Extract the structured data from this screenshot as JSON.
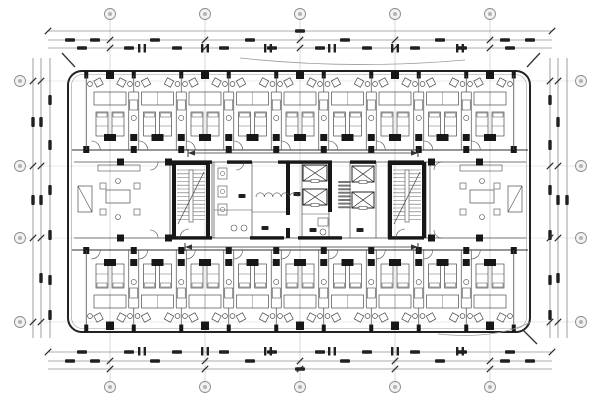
{
  "drawing": {
    "kind": "architectural-floor-plan-scan",
    "description": "typical hotel guest-room floor plan, double-loaded corridor, central core",
    "legible_text": "",
    "colors": {
      "bg": "#ffffff",
      "line": "#4b4b4b",
      "dark": "#171717",
      "light": "#9b9b9b",
      "dim": "#5e5e5e",
      "blob": "#202020",
      "bubble_stroke": "#8a8a8a",
      "bubble_fill": "#f2f2f2"
    }
  },
  "canvas": {
    "w": 600,
    "h": 400
  },
  "grid": {
    "top_bubbles": {
      "y": 14,
      "r": 5.5,
      "xs": [
        110,
        205,
        300,
        395,
        490
      ],
      "labels": [
        "",
        "",
        "",
        "",
        ""
      ]
    },
    "bottom_bubbles": {
      "y": 387,
      "r": 5.5,
      "xs": [
        110,
        205,
        300,
        395,
        490
      ],
      "labels": [
        "",
        "",
        "",
        "",
        ""
      ]
    },
    "left_bubbles": {
      "x": 20,
      "r": 5.5,
      "ys": [
        81,
        166,
        238,
        322
      ],
      "labels": [
        "",
        "",
        "",
        ""
      ]
    },
    "right_bubbles": {
      "x": 581,
      "r": 5.5,
      "ys": [
        81,
        166,
        238,
        322
      ],
      "labels": [
        "",
        "",
        "",
        ""
      ]
    }
  },
  "dims": {
    "top": {
      "ys": [
        31,
        40,
        48
      ],
      "x1": 48,
      "x2": 552,
      "blob_rows": [
        {
          "y": 31,
          "xs": [
            300
          ]
        },
        {
          "y": 40,
          "xs": [
            70,
            95,
            155,
            250,
            345,
            440,
            505,
            530
          ]
        },
        {
          "y": 48,
          "xs": [
            82,
            129,
            177,
            224,
            272,
            320,
            367,
            415,
            462,
            510
          ]
        }
      ],
      "hpairs": [
        142,
        205,
        268,
        332,
        395,
        460
      ],
      "hpair_y": 44
    },
    "bottom": {
      "ys": [
        352,
        361,
        369
      ],
      "x1": 48,
      "x2": 552,
      "blob_rows": [
        {
          "y": 352,
          "xs": [
            82,
            129,
            177,
            224,
            272,
            320,
            367,
            415,
            462,
            510
          ]
        },
        {
          "y": 361,
          "xs": [
            70,
            95,
            155,
            250,
            345,
            440,
            505,
            530
          ]
        },
        {
          "y": 369,
          "xs": [
            300
          ]
        }
      ],
      "hpairs": [
        142,
        205,
        268,
        332,
        395,
        460
      ],
      "hpair_y": 347
    },
    "left": {
      "xs": [
        33,
        41,
        50
      ],
      "y1": 58,
      "y2": 338,
      "blob_cols": [
        {
          "x": 33,
          "ys": [
            122,
            200
          ]
        },
        {
          "x": 41,
          "ys": [
            122,
            200,
            278
          ]
        },
        {
          "x": 50,
          "ys": [
            100,
            145,
            190,
            235,
            280,
            315
          ]
        }
      ]
    },
    "right": {
      "xs": [
        550,
        558,
        567
      ],
      "y1": 58,
      "y2": 338,
      "blob_cols": [
        {
          "x": 567,
          "ys": [
            200
          ]
        },
        {
          "x": 558,
          "ys": [
            122,
            200,
            278
          ]
        },
        {
          "x": 550,
          "ys": [
            100,
            145,
            190,
            235,
            280,
            315
          ]
        }
      ]
    }
  },
  "building": {
    "x": 68,
    "y": 71,
    "w": 462,
    "h": 261,
    "rx": 14,
    "inner_inset": 3.5
  },
  "bands": {
    "top": {
      "y0": 75,
      "y1": 150,
      "half": 23.75,
      "centers": [
        110,
        157.5,
        205,
        252.5,
        300,
        347.5,
        395,
        442.5,
        490
      ]
    },
    "bottom": {
      "y0": 250,
      "y1": 325,
      "half": 23.75,
      "centers": [
        110,
        157.5,
        205,
        252.5,
        300,
        347.5,
        395,
        442.5,
        490
      ]
    }
  },
  "corridors": {
    "top_wall_y": 150,
    "bottom_wall_y": 250,
    "x1": 72,
    "x2": 528,
    "arrows": [
      {
        "x1": 188,
        "x2": 418,
        "y": 153
      },
      {
        "x1": 185,
        "x2": 418,
        "y": 247
      }
    ]
  },
  "core": {
    "y0": 162,
    "y1": 238,
    "thin_v": [
      170,
      212,
      214,
      252,
      302,
      329,
      350,
      376,
      388,
      426,
      430
    ],
    "h_thin": [
      [
        214,
        252,
        210
      ],
      [
        252,
        286,
        212
      ],
      [
        302,
        329,
        214
      ]
    ],
    "thick_h_top": [
      [
        172,
        212
      ],
      [
        227,
        252
      ],
      [
        278,
        332
      ],
      [
        350,
        376
      ],
      [
        388,
        424
      ]
    ],
    "thick_h_bot": [
      [
        172,
        212
      ],
      [
        250,
        284
      ],
      [
        298,
        342
      ],
      [
        388,
        424
      ]
    ],
    "thick_v": [
      {
        "x": 288,
        "y1": 162,
        "y2": 215
      },
      {
        "x": 288,
        "y1": 228,
        "y2": 238
      },
      {
        "x": 330,
        "y1": 162,
        "y2": 212
      }
    ],
    "stairs": [
      {
        "x": 172,
        "w": 38
      },
      {
        "x": 388,
        "w": 38
      }
    ],
    "elevators": [
      {
        "x": 303,
        "y": 165,
        "w": 24,
        "h": 16
      },
      {
        "x": 303,
        "y": 189,
        "w": 24,
        "h": 16
      },
      {
        "x": 352,
        "y": 166,
        "w": 22,
        "h": 16
      },
      {
        "x": 352,
        "y": 192,
        "w": 22,
        "h": 16
      }
    ],
    "suites": [
      {
        "x": 74,
        "w": 96,
        "mirror": false
      },
      {
        "x": 430,
        "w": 96,
        "mirror": true
      }
    ],
    "wc_room": {
      "x": 214,
      "w": 38
    },
    "note_block": {
      "x": 338,
      "y": 181,
      "w": 13,
      "lines": 8,
      "line_h": 3.6
    },
    "labels": [
      [
        265,
        228
      ],
      [
        313,
        230
      ],
      [
        360,
        230
      ],
      [
        297,
        194
      ],
      [
        242,
        196
      ]
    ],
    "fixtures": [
      {
        "x": 318,
        "y": 218
      }
    ],
    "scallop": {
      "x1": 256,
      "y": 197,
      "n": 5,
      "r": 4.2
    }
  },
  "annotations": {
    "arc_top": "M 240 58 Q 350 70 465 60",
    "arc_bottom_right": "M 438 334 Q 495 340 531 322",
    "slashes": [
      [
        62,
        53,
        75,
        67
      ],
      [
        540,
        53,
        527,
        67
      ],
      [
        523,
        330,
        537,
        344
      ]
    ]
  }
}
